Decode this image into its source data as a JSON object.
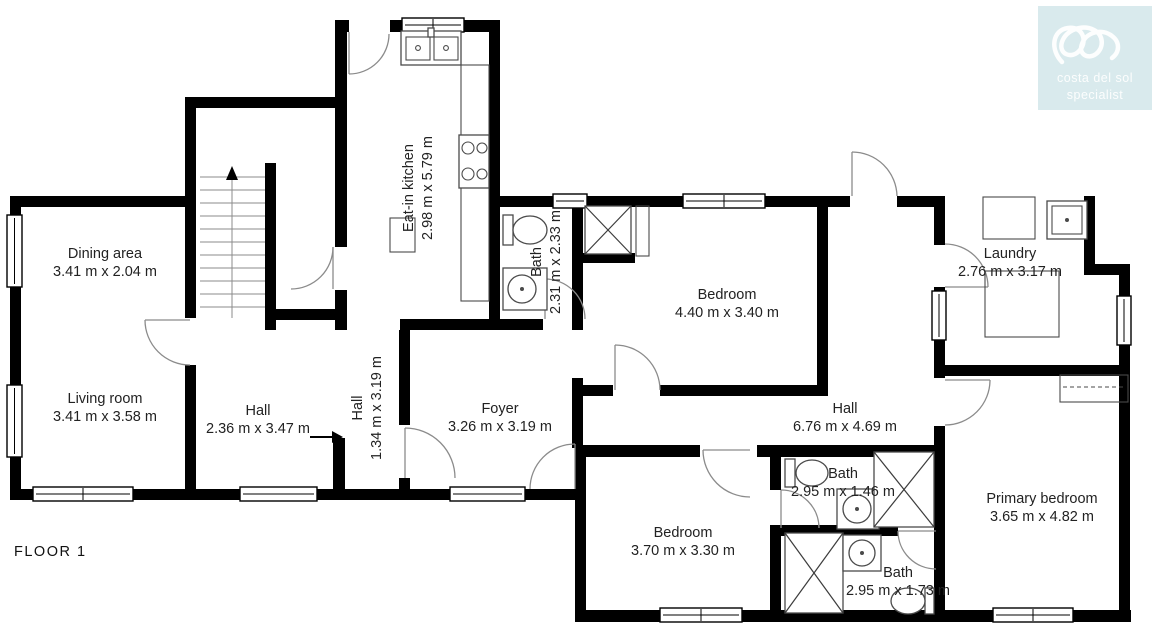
{
  "floor": {
    "label": "FLOOR 1"
  },
  "logo": {
    "line1": "costa del sol",
    "line2": "specialist",
    "bg_color": "#d9eaed",
    "text_color": "#ffffff",
    "icon": "scribble-loops-icon"
  },
  "colors": {
    "wall": "#000000",
    "door_arc": "#8b8b8b",
    "fixture_stroke": "#4a4a4a",
    "label_text": "#222222"
  },
  "rooms": [
    {
      "name": "Dining area",
      "dims": "3.41 m x 2.04 m"
    },
    {
      "name": "Living room",
      "dims": "3.41 m x 3.58 m"
    },
    {
      "name": "Hall",
      "dims": "2.36 m x 3.47 m"
    },
    {
      "name": "Hall",
      "dims": "1.34 m x 3.19 m"
    },
    {
      "name": "Eat-in kitchen",
      "dims": "2.98 m x 5.79 m"
    },
    {
      "name": "Bath",
      "dims": "2.31 m x 2.33 m"
    },
    {
      "name": "Bedroom",
      "dims": "4.40 m x 3.40 m"
    },
    {
      "name": "Foyer",
      "dims": "3.26 m x 3.19 m"
    },
    {
      "name": "Hall",
      "dims": "6.76 m x 4.69 m"
    },
    {
      "name": "Laundry",
      "dims": "2.76 m x 3.17 m"
    },
    {
      "name": "Bedroom",
      "dims": "3.70 m x 3.30 m"
    },
    {
      "name": "Bath",
      "dims": "2.95 m x 1.46 m"
    },
    {
      "name": "Bath",
      "dims": "2.95 m x 1.73 m"
    },
    {
      "name": "Primary bedroom",
      "dims": "3.65 m x 4.82 m"
    }
  ],
  "fixtures": [
    "stairs-up",
    "toilet",
    "sink",
    "shower",
    "stove",
    "kitchen-sink",
    "counter",
    "closet",
    "entry-arrow"
  ]
}
